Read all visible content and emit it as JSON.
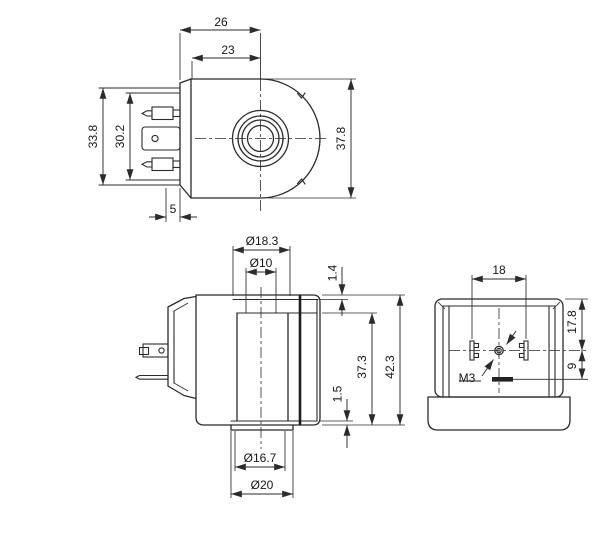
{
  "drawing": {
    "background": "#ffffff",
    "line_color": "#2b2b2b",
    "views": {
      "front_view": {
        "title": "coil-front-view",
        "dims": {
          "width_overall": "26",
          "width_body": "23",
          "connector_height": "33.8",
          "connector_inner_height": "30.2",
          "flange_thickness": "5",
          "body_diameter": "37.8"
        }
      },
      "side_view": {
        "title": "coil-side-view",
        "dims": {
          "tube_outer_dia": "Ø18.3",
          "bore_dia": "Ø10",
          "top_step": "1.4",
          "body_height": "37.3",
          "overall_height": "42.3",
          "bottom_step": "1.5",
          "spigot_dia": "Ø16.7",
          "flange_dia": "Ø20"
        }
      },
      "connector_top_view": {
        "title": "connector-top-view",
        "dims": {
          "pin_spacing": "18",
          "top_to_center": "17.8",
          "center_to_slot": "9",
          "screw_thread": "M3"
        }
      }
    }
  }
}
